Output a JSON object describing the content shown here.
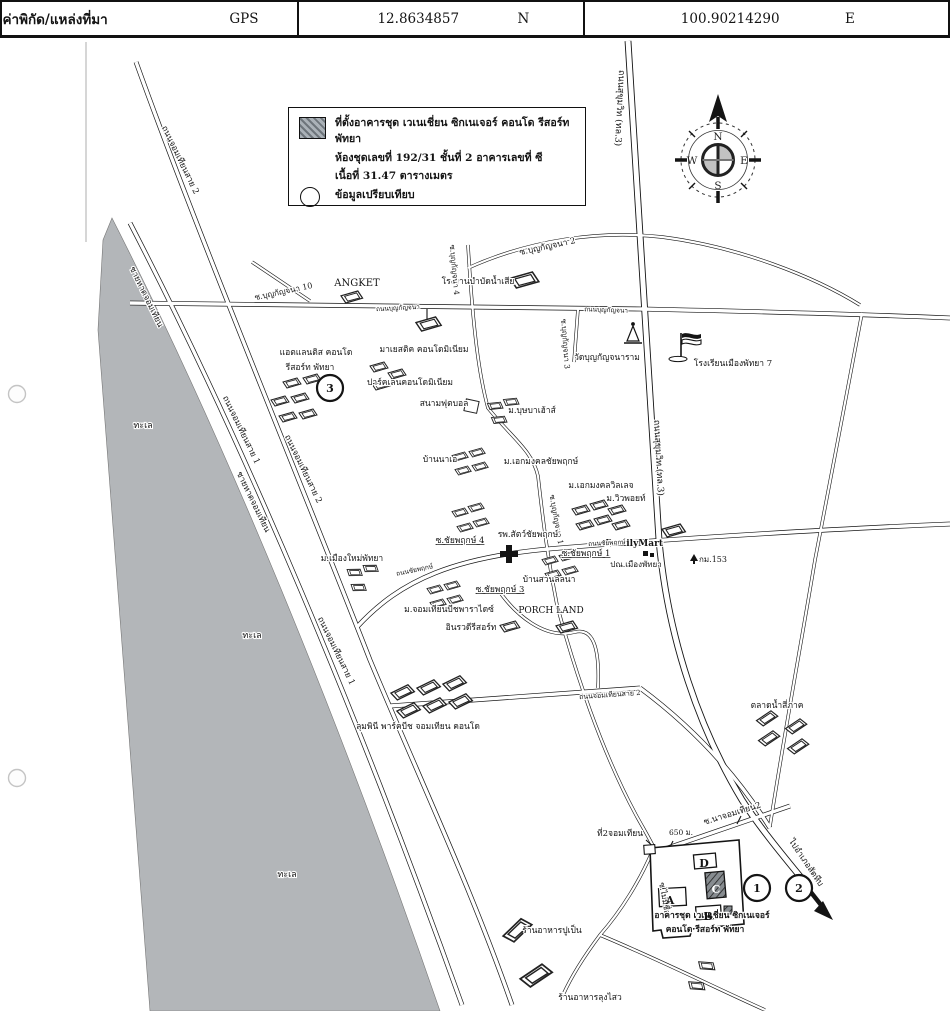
{
  "header": {
    "title": "ค่าพิกัด/แหล่งที่มา",
    "source": "GPS",
    "lat": "12.8634857",
    "lat_hemi": "N",
    "lng": "100.90214290",
    "lng_hemi": "E"
  },
  "legend": {
    "site_line": "ที่ตั้งอาคารชุด เวเนเชี่ยน ซิกเนเจอร์ คอนโด รีสอร์ท พัทยา",
    "unit_line": "ห้องชุดเลขที่ 192/31 ชั้นที่ 2  อาคารเลขที่ ซี",
    "area_line": "เนื้อที่ 31.47 ตารางเมตร",
    "compare_line": "ข้อมูลเปรียบเทียบ"
  },
  "compass": {
    "n": "N",
    "e": "E",
    "s": "S",
    "w": "W"
  },
  "colors": {
    "sea": "#b3b6b9",
    "ink": "#141414"
  },
  "map": {
    "labels": [
      {
        "t": "ถนนสุขุมวิท (ทล.3)",
        "x": 617,
        "y": 108,
        "r": 93,
        "s": 9
      },
      {
        "t": "ถนนสุขุมวิท (ทล.3)",
        "x": 656,
        "y": 458,
        "r": 87,
        "s": 9
      },
      {
        "t": "ซ.บุญกัญจนา 10",
        "x": 284,
        "y": 294,
        "r": -12,
        "s": 8
      },
      {
        "t": "ANGKET",
        "x": 357,
        "y": 286,
        "s": 10
      },
      {
        "t": "โรงงานบำบัดน้ำเสีย",
        "x": 478,
        "y": 284,
        "s": 8.5
      },
      {
        "t": "ซ.บุญกัญจนา 2",
        "x": 548,
        "y": 249,
        "r": -12,
        "s": 8.5
      },
      {
        "t": "ถนนบุญกัญจนา",
        "x": 398,
        "y": 310,
        "r": -3,
        "s": 6.5
      },
      {
        "t": "ถนนบุญกัญจนา",
        "x": 606,
        "y": 312,
        "r": 2,
        "s": 6.5
      },
      {
        "t": "วัดบุญกัญจนาราม",
        "x": 607,
        "y": 360,
        "s": 8.5
      },
      {
        "t": "โรงเรียนเมืองพัทยา 7",
        "x": 733,
        "y": 366,
        "s": 8.5
      },
      {
        "t": "แอตแลนติส คอนโด",
        "x": 316,
        "y": 355,
        "s": 8.5
      },
      {
        "t": "รีสอร์ท พัทยา",
        "x": 310,
        "y": 370,
        "s": 8.5
      },
      {
        "t": "มาเยสติค คอนโดมิเนียม",
        "x": 424,
        "y": 352,
        "s": 8.5
      },
      {
        "t": "ปาร์คเลนคอนโดมิเนียม",
        "x": 410,
        "y": 385,
        "s": 8.5
      },
      {
        "t": "สนามฟุตบอล",
        "x": 444,
        "y": 406,
        "s": 8.5
      },
      {
        "t": "ม.บุษบาเฮ้าส์",
        "x": 532,
        "y": 413,
        "s": 8.5
      },
      {
        "t": "บ้านนาเอ",
        "x": 440,
        "y": 462,
        "s": 8.5
      },
      {
        "t": "ม.เอกมงคลชัยพฤกษ์",
        "x": 541,
        "y": 464,
        "s": 8.5
      },
      {
        "t": "ม.เอกมงคลวิลเลจ",
        "x": 601,
        "y": 488,
        "s": 8.5
      },
      {
        "t": "ม.วิวพอยท์",
        "x": 626,
        "y": 501,
        "s": 8.5
      },
      {
        "t": "ซ.บุญกัญจนา 4",
        "x": 452,
        "y": 270,
        "r": 85,
        "s": 7.5
      },
      {
        "t": "ซ.บุญกัญจนา 3",
        "x": 563,
        "y": 344,
        "r": 86,
        "s": 7.5
      },
      {
        "t": "ซ.บุญกัญจนา 1",
        "x": 554,
        "y": 520,
        "r": 80,
        "s": 7.5
      },
      {
        "t": "ซ.ชัยพฤกษ์ 4",
        "x": 460,
        "y": 543,
        "s": 8.5,
        "u": 1
      },
      {
        "t": "รพ.สัตว์ชัยพฤกษ์",
        "x": 528,
        "y": 537,
        "s": 8.5
      },
      {
        "t": "ซ.ชัยพฤกษ์ 1",
        "x": 586,
        "y": 556,
        "s": 8.5,
        "u": 1
      },
      {
        "t": "FamilyMart",
        "x": 634,
        "y": 546,
        "s": 9,
        "w": 1
      },
      {
        "t": "ปณ.เมืองพัทยา",
        "x": 636,
        "y": 567,
        "s": 8
      },
      {
        "t": "กม.153",
        "x": 713,
        "y": 562,
        "s": 8
      },
      {
        "t": "ม.เมืองใหม่พัทยา",
        "x": 352,
        "y": 561,
        "s": 8.5
      },
      {
        "t": "ถนนชัยพฤกษ์",
        "x": 415,
        "y": 572,
        "r": -12,
        "s": 6.5
      },
      {
        "t": "ถนนชัยพฤกษ์",
        "x": 607,
        "y": 545,
        "r": -3,
        "s": 6.5
      },
      {
        "t": "ซ.ชัยพฤกษ์ 3",
        "x": 500,
        "y": 592,
        "s": 8.5,
        "u": 1
      },
      {
        "t": "บ้านสวนลลนา",
        "x": 549,
        "y": 582,
        "s": 8.5
      },
      {
        "t": "ม.จอมเทียนบีชพาราไดซ์",
        "x": 449,
        "y": 612,
        "s": 8.5
      },
      {
        "t": "PORCH LAND",
        "x": 551,
        "y": 613,
        "s": 9
      },
      {
        "t": "อินรวดีรีสอร์ท",
        "x": 471,
        "y": 630,
        "s": 8.5
      },
      {
        "t": "ถนนจอมเทียนสาย 2",
        "x": 610,
        "y": 697,
        "r": -4,
        "s": 7
      },
      {
        "t": "ตลาดน้ำสี่ภาค",
        "x": 777,
        "y": 708,
        "s": 8.5
      },
      {
        "t": "ลุมพินี พาร์คบีช จอมเทียน คอนโด",
        "x": 418,
        "y": 729,
        "s": 8.5
      },
      {
        "t": "ที่2จอมเทียน",
        "x": 620,
        "y": 836,
        "s": 8.5
      },
      {
        "t": "650 ม.",
        "x": 681,
        "y": 835,
        "s": 7.5
      },
      {
        "t": "ซ.นาจอมเทียน2",
        "x": 733,
        "y": 816,
        "r": -17,
        "s": 8.5
      },
      {
        "t": "ไปอำเภอสัตหีบ",
        "x": 804,
        "y": 864,
        "r": 56,
        "s": 8.5
      },
      {
        "t": "ซ.ไม่มีชื่อ",
        "x": 662,
        "y": 899,
        "r": 80,
        "s": 8
      },
      {
        "t": "ร้านอาหารปูเป็น",
        "x": 552,
        "y": 933,
        "s": 8.5
      },
      {
        "t": "ร้านอาหารลุงไสว",
        "x": 590,
        "y": 1000,
        "s": 8.5
      },
      {
        "t": "ทะเล",
        "x": 143,
        "y": 428,
        "s": 9
      },
      {
        "t": "ทะเล",
        "x": 252,
        "y": 638,
        "s": 9
      },
      {
        "t": "ทะเล",
        "x": 287,
        "y": 877,
        "s": 9
      },
      {
        "t": "ชายหาดจอมเทียน",
        "x": 144,
        "y": 298,
        "r": 64,
        "s": 8.5
      },
      {
        "t": "ชายหาดจอมเทียน",
        "x": 251,
        "y": 503,
        "r": 64,
        "s": 8.5
      },
      {
        "t": "ถนนจอมเทียนสาย 1",
        "x": 239,
        "y": 431,
        "r": 64,
        "s": 8.5
      },
      {
        "t": "ถนนจอมเทียนสาย 1",
        "x": 334,
        "y": 652,
        "r": 64,
        "s": 8.5
      },
      {
        "t": "ถนนจอมเทียนสาย 2",
        "x": 178,
        "y": 161,
        "r": 64,
        "s": 8.5
      },
      {
        "t": "ถนนจอมเทียนสาย 2",
        "x": 301,
        "y": 470,
        "r": 64,
        "s": 8.5
      },
      {
        "t": "อาคารชุด เวเนเชี่ยน ซิกเนเจอร์",
        "x": 712,
        "y": 918,
        "s": 8.5,
        "w": 1
      },
      {
        "t": "คอนโด รีสอร์ท พัทยา",
        "x": 705,
        "y": 932,
        "s": 8.5,
        "w": 1
      }
    ],
    "circles": [
      {
        "n": "3",
        "x": 330,
        "y": 388
      },
      {
        "n": "1",
        "x": 757,
        "y": 888
      },
      {
        "n": "2",
        "x": 799,
        "y": 888
      }
    ],
    "blocks": [
      {
        "t": "D",
        "x": 704,
        "y": 867
      },
      {
        "t": "C",
        "x": 716,
        "y": 893,
        "f": "#ffffff"
      },
      {
        "t": "A",
        "x": 670,
        "y": 904
      },
      {
        "t": "B",
        "x": 708,
        "y": 920
      }
    ]
  }
}
